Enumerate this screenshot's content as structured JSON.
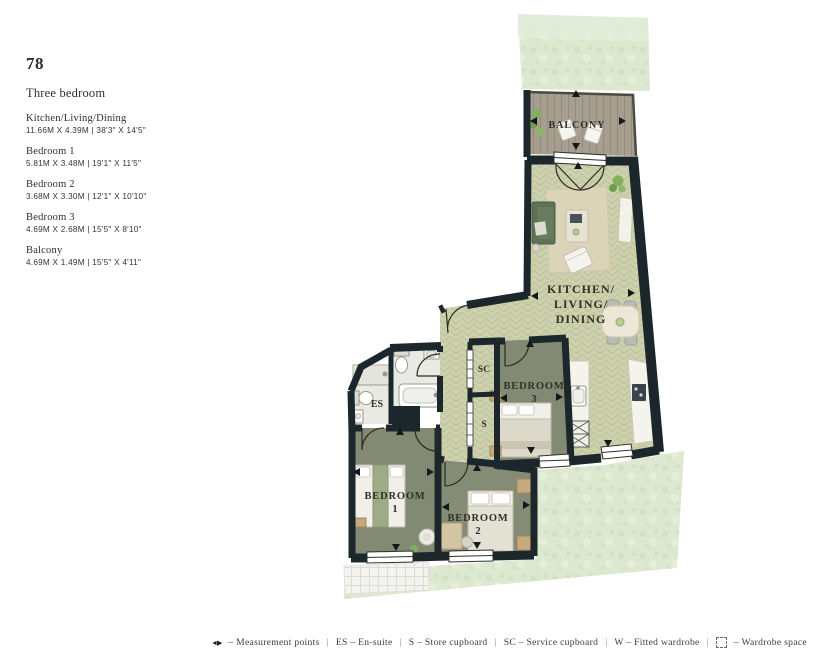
{
  "unit": {
    "plot_number": "78",
    "type_label": "Three bedroom",
    "rooms": [
      {
        "name": "Kitchen/Living/Dining",
        "dims": "11.66M X 4.39M | 38'3\" X 14'5\""
      },
      {
        "name": "Bedroom 1",
        "dims": "5.81M X 3.48M | 19'1\" X 11'5\""
      },
      {
        "name": "Bedroom 2",
        "dims": "3.68M X 3.30M | 12'1\" X 10'10\""
      },
      {
        "name": "Bedroom 3",
        "dims": "4.69M X 2.68M | 15'5\" X 8'10\""
      },
      {
        "name": "Balcony",
        "dims": "4.69M X 1.49M | 15'5\" X 4'11\""
      }
    ]
  },
  "plan": {
    "labels": {
      "balcony": "BALCONY",
      "kitchen_line1": "KITCHEN/",
      "kitchen_line2": "LIVING/",
      "kitchen_line3": "DINING",
      "bedroom_word": "BEDROOM",
      "bedroom1_number": "1",
      "bedroom2_number": "2",
      "bedroom3_number": "3",
      "ensuite": "ES",
      "service_cupboard": "SC",
      "store_cupboard": "S"
    },
    "colors": {
      "wall": "#1c272b",
      "wood_floor": "#cdd1ae",
      "bedroom_floor": "#828a73",
      "garden": "#dce8cf",
      "deck": "#a69e8f",
      "sofa_green": "#5e7257"
    }
  },
  "legend": {
    "separator": "|",
    "measurement_symbol": "◄▶",
    "entries": [
      {
        "label": "– Measurement points"
      },
      {
        "label": "ES – En-suite"
      },
      {
        "label": "S – Store cupboard"
      },
      {
        "label": "SC – Service cupboard"
      },
      {
        "label": "W – Fitted wardrobe"
      },
      {
        "label": "– Wardrobe space"
      }
    ]
  }
}
